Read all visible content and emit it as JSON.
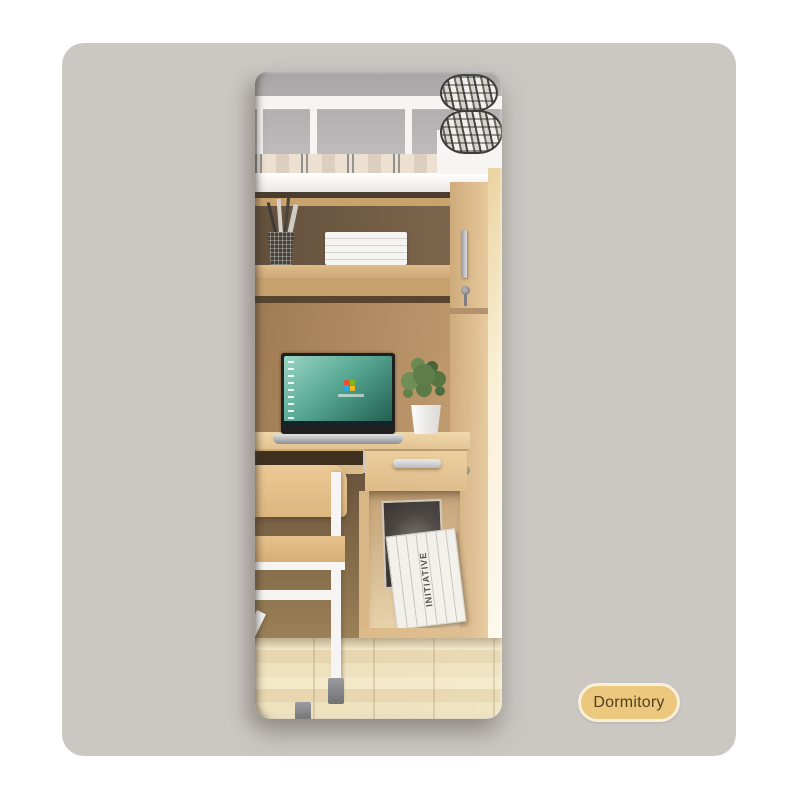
{
  "theme": {
    "page-bg": "#ffffff",
    "card-bg": "#cbc8c4",
    "badge-bg": "#ecc87e",
    "badge-border": "#f8f0da",
    "badge-text": "#54401f",
    "white-frame": "#f6f5f3",
    "wood-light": "#d9b686",
    "wood-mid": "#c7a26f",
    "wood-dark": "#6b5742",
    "wood-tan": "#b08a5f",
    "floor": "#ecdfbc"
  },
  "badge": {
    "label": "Dormitory"
  },
  "mirror_scene": {
    "book_spine_text": "INITIATIVE"
  }
}
